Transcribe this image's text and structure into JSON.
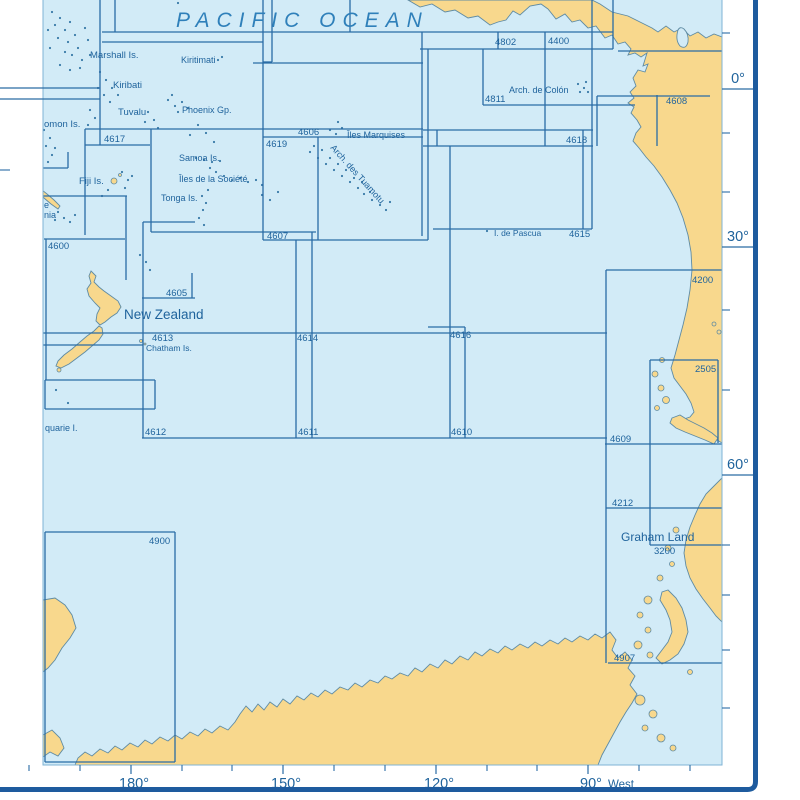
{
  "map_title": "PACIFIC OCEAN",
  "colors": {
    "sea": "#d2ebf7",
    "land": "#f8d88d",
    "coast": "#5f8ba3",
    "index_line": "#2a6ca5",
    "label_text": "#1f639c",
    "title_text": "#2f80ba",
    "border": "#1e5b9e",
    "neatline": "#7fb3d4",
    "dot": "#3a7aa8"
  },
  "chart_numbers": [
    {
      "t": "4802",
      "x": 495,
      "y": 45
    },
    {
      "t": "4400",
      "x": 548,
      "y": 44
    },
    {
      "t": "4811",
      "x": 485,
      "y": 102
    },
    {
      "t": "4608",
      "x": 666,
      "y": 104
    },
    {
      "t": "4617",
      "x": 104,
      "y": 142
    },
    {
      "t": "4606",
      "x": 298,
      "y": 135
    },
    {
      "t": "4619",
      "x": 266,
      "y": 147
    },
    {
      "t": "4618",
      "x": 566,
      "y": 143
    },
    {
      "t": "4600",
      "x": 48,
      "y": 249
    },
    {
      "t": "4607",
      "x": 267,
      "y": 239
    },
    {
      "t": "4615",
      "x": 569,
      "y": 237
    },
    {
      "t": "4605",
      "x": 166,
      "y": 296
    },
    {
      "t": "4613",
      "x": 152,
      "y": 341
    },
    {
      "t": "4614",
      "x": 297,
      "y": 341
    },
    {
      "t": "4616",
      "x": 450,
      "y": 338
    },
    {
      "t": "4200",
      "x": 692,
      "y": 283
    },
    {
      "t": "2505",
      "x": 695,
      "y": 372
    },
    {
      "t": "4612",
      "x": 145,
      "y": 435
    },
    {
      "t": "4611",
      "x": 298,
      "y": 435
    },
    {
      "t": "4610",
      "x": 451,
      "y": 435
    },
    {
      "t": "4609",
      "x": 610,
      "y": 442
    },
    {
      "t": "4212",
      "x": 612,
      "y": 506
    },
    {
      "t": "3200",
      "x": 654,
      "y": 554
    },
    {
      "t": "4907",
      "x": 614,
      "y": 661
    },
    {
      "t": "4900",
      "x": 149,
      "y": 544
    }
  ],
  "place_labels": [
    {
      "t": "PACIFIC OCEAN",
      "x": 176,
      "y": 27,
      "s": 21,
      "italic": true,
      "ls": 7,
      "title": true
    },
    {
      "t": "Marshall Is.",
      "x": 90,
      "y": 58,
      "s": 9.5
    },
    {
      "t": "Kiritimati",
      "x": 181,
      "y": 63,
      "s": 9
    },
    {
      "t": "Kiribati",
      "x": 113,
      "y": 88,
      "s": 9.5
    },
    {
      "t": "Tuvalu",
      "x": 118,
      "y": 115,
      "s": 9.5
    },
    {
      "t": "Phoenix Gp.",
      "x": 182,
      "y": 113,
      "s": 9
    },
    {
      "t": "omon Is.",
      "x": 44,
      "y": 127,
      "s": 9.5
    },
    {
      "t": "Fiji Is.",
      "x": 79,
      "y": 184,
      "s": 9.5
    },
    {
      "t": "Samoa Is.",
      "x": 179,
      "y": 161,
      "s": 9
    },
    {
      "t": "Îles de la Société",
      "x": 179,
      "y": 182,
      "s": 9
    },
    {
      "t": "Tonga Is.",
      "x": 161,
      "y": 201,
      "s": 9
    },
    {
      "t": "Îles Marquises",
      "x": 347,
      "y": 138,
      "s": 9
    },
    {
      "t": "Arch. des Tuamotu",
      "x": 330,
      "y": 148,
      "s": 9,
      "rot": 48
    },
    {
      "t": "Arch. de Colón",
      "x": 509,
      "y": 93,
      "s": 9
    },
    {
      "t": "I. de Pascua",
      "x": 494,
      "y": 236,
      "s": 8.5
    },
    {
      "t": "New Zealand",
      "x": 124,
      "y": 319,
      "s": 13.5
    },
    {
      "t": "Chatham Is.",
      "x": 146,
      "y": 351,
      "s": 8.5
    },
    {
      "t": "quarie I.",
      "x": 45,
      "y": 431,
      "s": 9
    },
    {
      "t": "e",
      "x": 44,
      "y": 208,
      "s": 9
    },
    {
      "t": "nia",
      "x": 44,
      "y": 218,
      "s": 9
    },
    {
      "t": "Graham Land",
      "x": 621,
      "y": 541,
      "s": 12
    }
  ],
  "axis": {
    "right_major": [
      {
        "label": "0°",
        "y": 89
      },
      {
        "label": "30°",
        "y": 247
      },
      {
        "label": "60°",
        "y": 475
      }
    ],
    "right_minor_y": [
      33,
      133,
      192,
      310,
      390,
      545,
      595,
      650,
      708
    ],
    "bottom_major": [
      {
        "label": "180°",
        "x": 131
      },
      {
        "label": "150°",
        "x": 283
      },
      {
        "label": "120°",
        "x": 436
      },
      {
        "label": "90°",
        "x": 588,
        "suffix": "West"
      }
    ],
    "bottom_minor_x": [
      29,
      80,
      182,
      232,
      334,
      385,
      487,
      537,
      639,
      690
    ],
    "left_margin_lines_y": [
      88,
      99
    ],
    "left_margin_tick_y": 170
  },
  "index_lines": [
    [
      102,
      32,
      613,
      32
    ],
    [
      102,
      42,
      263,
      42
    ],
    [
      420,
      49,
      613,
      49
    ],
    [
      253,
      63,
      423,
      63
    ],
    [
      263,
      62,
      272,
      62
    ],
    [
      483,
      105,
      635,
      105
    ],
    [
      597,
      96,
      710,
      96
    ],
    [
      618,
      51,
      722,
      51
    ],
    [
      85,
      129,
      423,
      129
    ],
    [
      263,
      137,
      423,
      137
    ],
    [
      423,
      130,
      593,
      130
    ],
    [
      423,
      146,
      593,
      146
    ],
    [
      85,
      145,
      150,
      145
    ],
    [
      43,
      168,
      68,
      168
    ],
    [
      43,
      196,
      127,
      196
    ],
    [
      433,
      229,
      592,
      229
    ],
    [
      143,
      222,
      195,
      222
    ],
    [
      151,
      232,
      316,
      232
    ],
    [
      263,
      240,
      428,
      240
    ],
    [
      142,
      298,
      195,
      298
    ],
    [
      606,
      270,
      722,
      270
    ],
    [
      43,
      333,
      607,
      333
    ],
    [
      43,
      345,
      143,
      345
    ],
    [
      142,
      438,
      607,
      438
    ],
    [
      650,
      360,
      718,
      360
    ],
    [
      605,
      444,
      722,
      444
    ],
    [
      606,
      508,
      722,
      508
    ],
    [
      650,
      545,
      722,
      545
    ],
    [
      608,
      663,
      722,
      663
    ],
    [
      44,
      239,
      125,
      239
    ],
    [
      45,
      380,
      155,
      380
    ],
    [
      45,
      409,
      155,
      409
    ],
    [
      45,
      532,
      175,
      532
    ],
    [
      45,
      762,
      175,
      762
    ],
    [
      428,
      327,
      465,
      327
    ],
    [
      100,
      0,
      100,
      145
    ],
    [
      115,
      0,
      115,
      32
    ],
    [
      85,
      129,
      85,
      235
    ],
    [
      151,
      129,
      151,
      232
    ],
    [
      263,
      0,
      263,
      240
    ],
    [
      272,
      0,
      272,
      62
    ],
    [
      350,
      0,
      350,
      32
    ],
    [
      318,
      137,
      318,
      240
    ],
    [
      422,
      32,
      422,
      236
    ],
    [
      428,
      49,
      428,
      240
    ],
    [
      437,
      130,
      437,
      146
    ],
    [
      450,
      146,
      450,
      438
    ],
    [
      465,
      327,
      465,
      438
    ],
    [
      545,
      32,
      545,
      146
    ],
    [
      592,
      0,
      592,
      229
    ],
    [
      583,
      130,
      583,
      229
    ],
    [
      613,
      0,
      613,
      49
    ],
    [
      498,
      32,
      498,
      49
    ],
    [
      483,
      49,
      483,
      105
    ],
    [
      657,
      95,
      657,
      146
    ],
    [
      597,
      96,
      597,
      146
    ],
    [
      606,
      270,
      606,
      663
    ],
    [
      650,
      360,
      650,
      545
    ],
    [
      718,
      360,
      718,
      443
    ],
    [
      143,
      222,
      143,
      438
    ],
    [
      296,
      240,
      296,
      438
    ],
    [
      312,
      232,
      312,
      438
    ],
    [
      46,
      239,
      46,
      380
    ],
    [
      126,
      196,
      126,
      280
    ],
    [
      45,
      380,
      45,
      409
    ],
    [
      155,
      380,
      155,
      409
    ],
    [
      45,
      532,
      45,
      762
    ],
    [
      175,
      532,
      175,
      762
    ],
    [
      68,
      152,
      68,
      168
    ],
    [
      192,
      273,
      192,
      298
    ]
  ],
  "land": [
    {
      "name": "central-south-america",
      "d": "M 408,0 L 420,7 432,4 445,12 455,10 468,18 478,16 490,25 498,22 506,20 513,11 520,15 530,6 541,4 548,9 556,19 565,14 572,22 580,20 588,28 596,26 605,38 612,35 618,44 625,42 631,49 628,55 635,53 641,57 647,53 643,66 648,64 645,72 638,70 633,78 636,86 630,92 634,98 628,103 634,107 631,113 637,120 641,127 636,133 633,141 639,148 646,157 654,166 662,177 670,190 677,203 683,218 688,235 691,252 692,270 690,290 687,308 683,325 679,340 675,355 671,368 674,378 680,386 686,394 691,403 694,412 690,417 684,419 690,424 698,428 706,433 714,438 722,443 722,37 714,34 706,38 698,32 690,36 682,28 674,32 666,26 658,32 652,28 640,22 628,16 612,12 600,4 592,0 Z"
    },
    {
      "name": "lake-maracaibo",
      "sea": true,
      "d": "M 678,30 Q 675,40 680,46 Q 686,50 688,42 Q 689,34 684,29 Q 680,26 678,30 Z"
    },
    {
      "name": "tierra-del-fuego",
      "d": "M 672,418 L 680,415 688,420 696,424 704,428 712,433 718,438 714,444 705,440 695,436 685,432 676,428 670,423 Z"
    },
    {
      "name": "nz-north-island",
      "d": "M 91,271 L 96,276 94,282 99,287 104,291 111,296 118,301 121,307 117,313 111,317 105,322 100,325 96,321 97,314 100,308 95,303 89,296 87,289 91,283 89,276 Z"
    },
    {
      "name": "nz-south-island",
      "d": "M 99,326 L 94,331 87,336 80,342 72,349 64,355 58,361 56,366 61,368 69,364 77,358 85,352 92,346 99,340 103,334 102,328 Z"
    },
    {
      "name": "new-caledonia",
      "d": "M 42,190 L 47,194 54,200 60,206 58,209 51,204 44,198 40,193 Z"
    },
    {
      "name": "antarctica-mainland",
      "d": "M 75,765 L 78,758 85,752 92,756 100,749 108,753 115,746 122,750 130,743 138,747 145,740 152,744 160,737 168,741 175,735 182,739 190,732 198,736 205,729 212,733 220,726 228,730 235,722 240,714 246,706 252,712 258,704 264,710 270,702 277,707 283,699 290,704 297,696 304,700 311,693 318,697 325,690 332,694 340,687 348,690 355,683 362,687 370,680 378,683 385,676 392,679 400,673 408,676 415,668 422,672 430,664 438,668 445,660 452,664 460,656 468,660 475,652 482,656 490,649 498,653 505,646 512,650 520,644 528,648 535,642 542,646 550,640 558,644 565,638 572,642 580,636 588,640 595,634 602,638 610,632 616,640 612,650 618,658 625,652 632,660 628,668 635,676 630,685 637,694 632,703 626,712 620,722 614,733 608,744 602,755 598,765 Z"
    },
    {
      "name": "antarctica-left-island",
      "d": "M 43,600 L 55,598 65,605 72,615 76,628 70,638 62,648 55,660 48,668 43,672 Z"
    },
    {
      "name": "antarctica-left-corner",
      "d": "M 43,735 L 52,730 60,738 64,748 58,756 50,752 43,757 Z"
    },
    {
      "name": "graham-land-peninsula",
      "d": "M 722,478 L 714,486 706,494 700,504 695,515 690,527 686,540 684,553 686,566 690,578 696,589 703,599 710,608 716,616 722,622 Z"
    },
    {
      "name": "peninsula-arc-island",
      "d": "M 668,590 L 676,598 682,608 686,620 688,632 684,644 678,654 670,660 662,664 656,658 662,650 668,642 672,632 670,620 666,610 660,600 662,592 Z"
    }
  ],
  "islets": [
    [
      114,
      181,
      3
    ],
    [
      120,
      175,
      1.5
    ],
    [
      59,
      370,
      2
    ],
    [
      141,
      341,
      1.5
    ],
    [
      145,
      344,
      1
    ],
    [
      662,
      360,
      2.5
    ],
    [
      655,
      374,
      3
    ],
    [
      661,
      388,
      3
    ],
    [
      666,
      400,
      3.5
    ],
    [
      657,
      408,
      2.5
    ],
    [
      714,
      324,
      2
    ],
    [
      719,
      332,
      2
    ],
    [
      676,
      530,
      3
    ],
    [
      668,
      548,
      3
    ],
    [
      672,
      564,
      2.5
    ],
    [
      660,
      578,
      3
    ],
    [
      648,
      600,
      4
    ],
    [
      640,
      615,
      3
    ],
    [
      648,
      630,
      3
    ],
    [
      638,
      645,
      4
    ],
    [
      650,
      655,
      3
    ],
    [
      640,
      700,
      5
    ],
    [
      653,
      714,
      4
    ],
    [
      645,
      728,
      3
    ],
    [
      661,
      738,
      4
    ],
    [
      673,
      748,
      3
    ],
    [
      690,
      672,
      2.5
    ]
  ],
  "island_dots": [
    [
      52,
      12
    ],
    [
      60,
      18
    ],
    [
      55,
      25
    ],
    [
      65,
      30
    ],
    [
      70,
      22
    ],
    [
      75,
      35
    ],
    [
      68,
      42
    ],
    [
      58,
      38
    ],
    [
      78,
      48
    ],
    [
      72,
      55
    ],
    [
      82,
      60
    ],
    [
      65,
      52
    ],
    [
      88,
      40
    ],
    [
      60,
      65
    ],
    [
      70,
      70
    ],
    [
      80,
      68
    ],
    [
      90,
      55
    ],
    [
      85,
      28
    ],
    [
      48,
      30
    ],
    [
      50,
      48
    ],
    [
      100,
      72
    ],
    [
      106,
      80
    ],
    [
      112,
      88
    ],
    [
      104,
      95
    ],
    [
      110,
      102
    ],
    [
      118,
      95
    ],
    [
      98,
      88
    ],
    [
      90,
      110
    ],
    [
      95,
      118
    ],
    [
      88,
      125
    ],
    [
      168,
      100
    ],
    [
      175,
      106
    ],
    [
      182,
      102
    ],
    [
      178,
      112
    ],
    [
      188,
      108
    ],
    [
      172,
      95
    ],
    [
      218,
      60
    ],
    [
      222,
      57
    ],
    [
      148,
      112
    ],
    [
      154,
      120
    ],
    [
      145,
      122
    ],
    [
      158,
      128
    ],
    [
      196,
      158
    ],
    [
      204,
      160
    ],
    [
      212,
      162
    ],
    [
      220,
      161
    ],
    [
      216,
      172
    ],
    [
      224,
      176
    ],
    [
      232,
      180
    ],
    [
      240,
      178
    ],
    [
      248,
      182
    ],
    [
      256,
      180
    ],
    [
      262,
      185
    ],
    [
      210,
      168
    ],
    [
      202,
      196
    ],
    [
      206,
      203
    ],
    [
      203,
      210
    ],
    [
      208,
      190
    ],
    [
      199,
      218
    ],
    [
      204,
      225
    ],
    [
      122,
      172
    ],
    [
      128,
      180
    ],
    [
      125,
      188
    ],
    [
      132,
      176
    ],
    [
      108,
      190
    ],
    [
      102,
      196
    ],
    [
      58,
      212
    ],
    [
      64,
      218
    ],
    [
      70,
      222
    ],
    [
      55,
      220
    ],
    [
      75,
      215
    ],
    [
      262,
      195
    ],
    [
      270,
      200
    ],
    [
      278,
      192
    ],
    [
      310,
      152
    ],
    [
      318,
      158
    ],
    [
      326,
      164
    ],
    [
      334,
      170
    ],
    [
      342,
      176
    ],
    [
      350,
      182
    ],
    [
      358,
      188
    ],
    [
      364,
      194
    ],
    [
      372,
      200
    ],
    [
      380,
      205
    ],
    [
      330,
      158
    ],
    [
      338,
      164
    ],
    [
      346,
      170
    ],
    [
      354,
      178
    ],
    [
      322,
      150
    ],
    [
      314,
      146
    ],
    [
      362,
      182
    ],
    [
      370,
      192
    ],
    [
      386,
      210
    ],
    [
      390,
      202
    ],
    [
      330,
      130
    ],
    [
      336,
      134
    ],
    [
      342,
      128
    ],
    [
      338,
      122
    ],
    [
      487,
      231
    ],
    [
      578,
      84
    ],
    [
      584,
      88
    ],
    [
      580,
      92
    ],
    [
      588,
      92
    ],
    [
      586,
      82
    ],
    [
      44,
      130
    ],
    [
      50,
      138
    ],
    [
      46,
      146
    ],
    [
      52,
      155
    ],
    [
      48,
      162
    ],
    [
      55,
      148
    ],
    [
      198,
      125
    ],
    [
      206,
      133
    ],
    [
      214,
      142
    ],
    [
      190,
      135
    ],
    [
      140,
      255
    ],
    [
      146,
      262
    ],
    [
      150,
      270
    ],
    [
      56,
      390
    ],
    [
      68,
      403
    ],
    [
      178,
      3
    ]
  ],
  "layout": {
    "map_left": 43,
    "map_right": 722,
    "map_bottom": 765,
    "border_x": 755.5,
    "border_y": 789.5
  }
}
